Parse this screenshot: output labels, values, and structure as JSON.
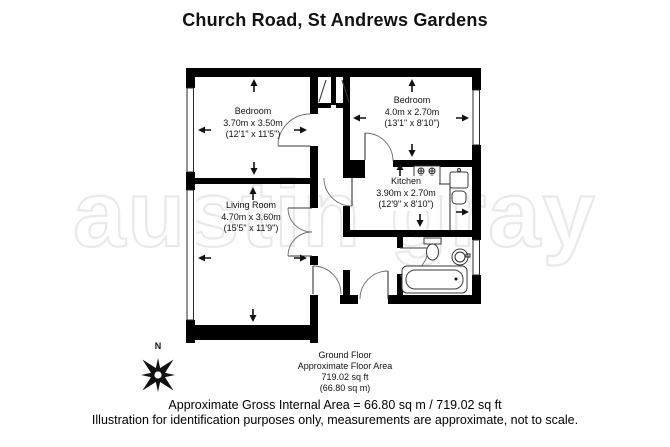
{
  "title": "Church Road, St Andrews Gardens",
  "watermark_text": "austin gray",
  "compass": {
    "north_label": "N"
  },
  "rooms": [
    {
      "id": "bedroom-left",
      "name": "Bedroom",
      "metric": "3.70m x 3.50m",
      "imperial": "(12'1\" x 11'5\")"
    },
    {
      "id": "bedroom-right",
      "name": "Bedroom",
      "metric": "4.0m x 2.70m",
      "imperial": "(13'1\" x 8'10\")"
    },
    {
      "id": "kitchen",
      "name": "Kitchen",
      "metric": "3.90m x 2.70m",
      "imperial": "(12'9\" x 8'10\")"
    },
    {
      "id": "living-room",
      "name": "Living Room",
      "metric": "4.70m x 3.60m",
      "imperial": "(15'5\" x 11'9\")"
    }
  ],
  "floor_summary": {
    "floor_name": "Ground Floor",
    "area_label": "Approximate Floor Area",
    "area_sqft": "719.02 sq ft",
    "area_sqm": "(66.80 sq m)"
  },
  "footer": {
    "line1": "Approximate Gross Internal Area = 66.80 sq m / 719.02 sq ft",
    "line2": "Illustration for identification purposes only, measurements are approximate, not to scale."
  },
  "colors": {
    "wall": "#000000",
    "text": "#1c1c1c",
    "watermark_outline": "#e9e9e9",
    "background": "#ffffff"
  }
}
